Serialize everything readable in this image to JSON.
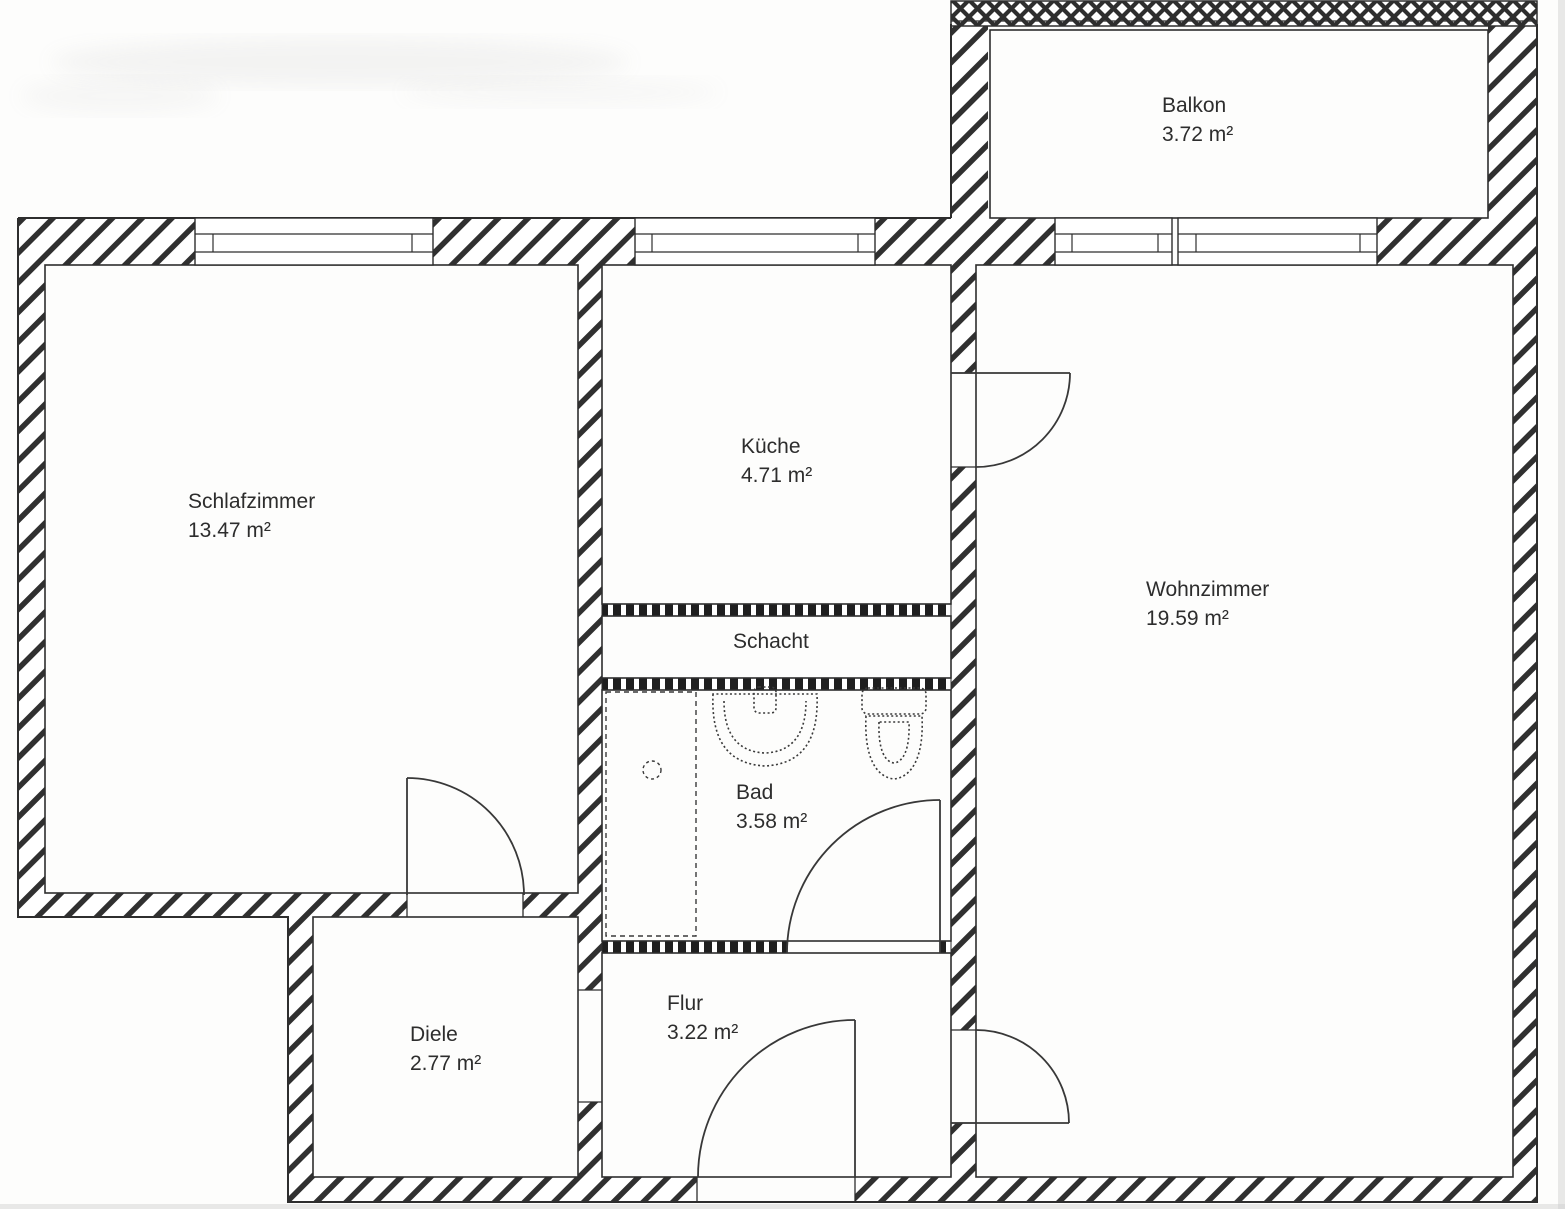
{
  "document": {
    "type": "apartment-floor-plan",
    "area_unit": "m²"
  },
  "colors": {
    "ink": "#2e2e2e",
    "paper": "#fdfdfc",
    "hatch": "#303030"
  },
  "rooms": [
    {
      "id": "balkon",
      "label": "Balkon",
      "area": "3.72 m²"
    },
    {
      "id": "schlafzimmer",
      "label": "Schlafzimmer",
      "area": "13.47 m²"
    },
    {
      "id": "kueche",
      "label": "Küche",
      "area": "4.71 m²"
    },
    {
      "id": "schacht",
      "label": "Schacht",
      "area": ""
    },
    {
      "id": "bad",
      "label": "Bad",
      "area": "3.58 m²"
    },
    {
      "id": "wohnzimmer",
      "label": "Wohnzimmer",
      "area": "19.59 m²"
    },
    {
      "id": "diele",
      "label": "Diele",
      "area": "2.77 m²"
    },
    {
      "id": "flur",
      "label": "Flur",
      "area": "3.22 m²"
    }
  ]
}
